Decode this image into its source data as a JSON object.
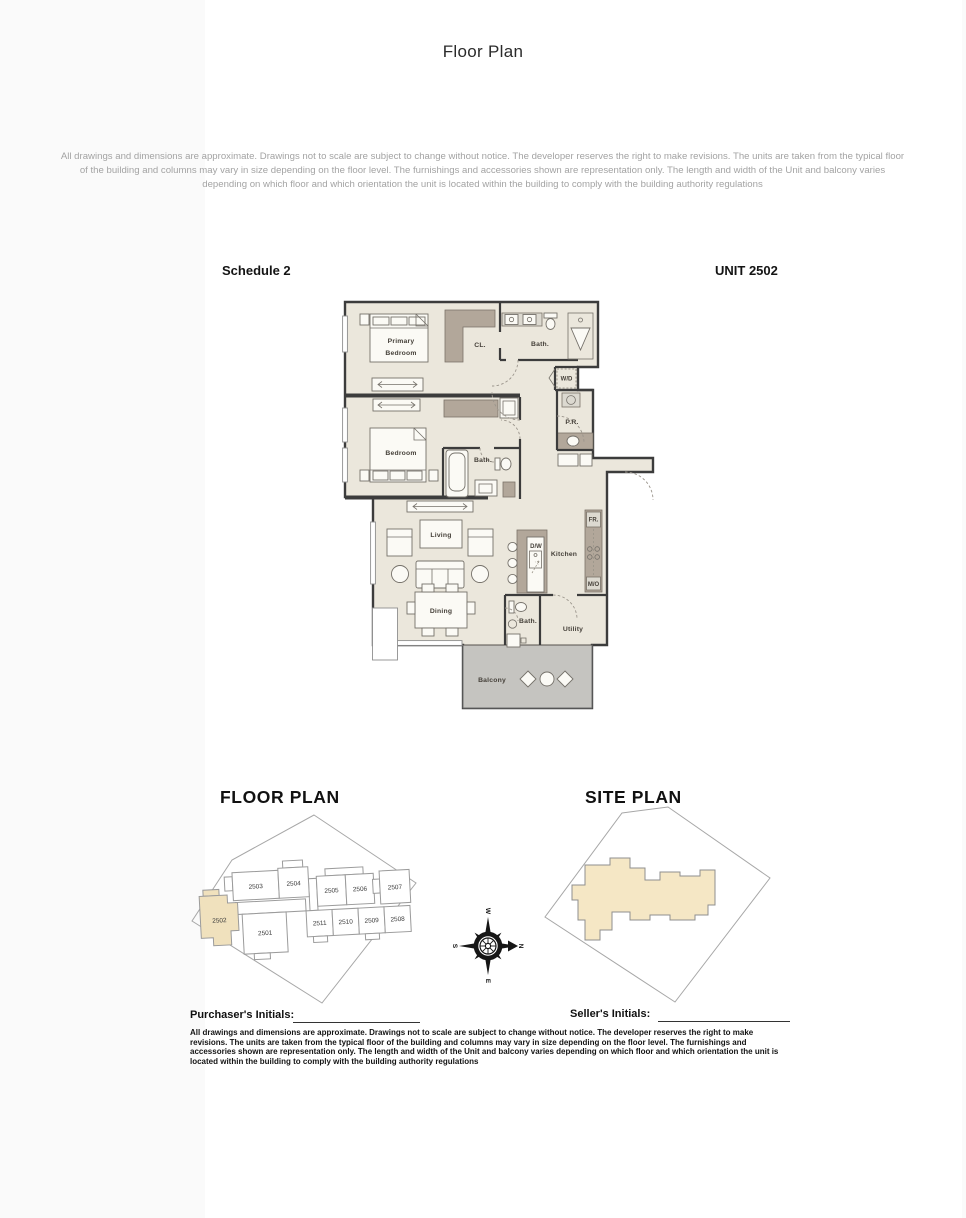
{
  "page": {
    "title": "Floor Plan",
    "disclaimer_top": "All drawings and dimensions are approximate. Drawings not to  scale  are subject to change without notice. The developer reserves the right to make revisions. The units are taken from the typical floor of the building  and columns may vary in size depending on the floor level. The furnishings and accessories shown are representation only. The length and width of the Unit  and balcony varies depending on which floor and which orientation the unit is located within the building to comply with the building authority regulations",
    "disclaimer_bottom": "All drawings and dimensions are approximate. Drawings not to  scale  are subject to change without notice. The developer reserves the right to make revisions. The units are taken from the typical floor of the building  and columns may vary in size depending on the floor level. The furnishings and accessories shown are representation only. The length and width of the Unit  and balcony varies depending on which floor and which orientation the unit is located within the building to comply with the building authority regulations",
    "schedule_label": "Schedule 2",
    "unit_label": "UNIT 2502"
  },
  "plan": {
    "labels": {
      "primary_line1": "Primary",
      "primary_line2": "Bedroom",
      "cl": "CL.",
      "bath_main": "Bath.",
      "wd": "W/D",
      "pr": "P.R.",
      "bedroom": "Bedroom",
      "bath2": "Bath.",
      "living": "Living",
      "dining": "Dining",
      "dw": "D/W",
      "kitchen": "Kitchen",
      "fr": "FR.",
      "mo": "M/O",
      "bath3": "Bath.",
      "utility": "Utility",
      "balcony": "Balcony"
    }
  },
  "keyplan": {
    "title": "FLOOR PLAN",
    "highlighted_unit": "2502",
    "units": {
      "u2503": "2503",
      "u2504": "2504",
      "u2505": "2505",
      "u2506": "2506",
      "u2507": "2507",
      "u2502": "2502",
      "u2501": "2501",
      "u2511": "2511",
      "u2510": "2510",
      "u2509": "2509",
      "u2508": "2508"
    }
  },
  "siteplan": {
    "title": "SITE PLAN"
  },
  "compass": {
    "top": "W",
    "right": "N",
    "bottom": "E",
    "left": "S"
  },
  "signatures": {
    "purchaser": "Purchaser's Initials:",
    "seller": "Seller's Initials:"
  },
  "colors": {
    "floor": "#ebe7dc",
    "closet": "#b2a79a",
    "balcony": "#c5c4c0",
    "highlight": "#f0e1bd",
    "wall": "#3c3c3c"
  }
}
